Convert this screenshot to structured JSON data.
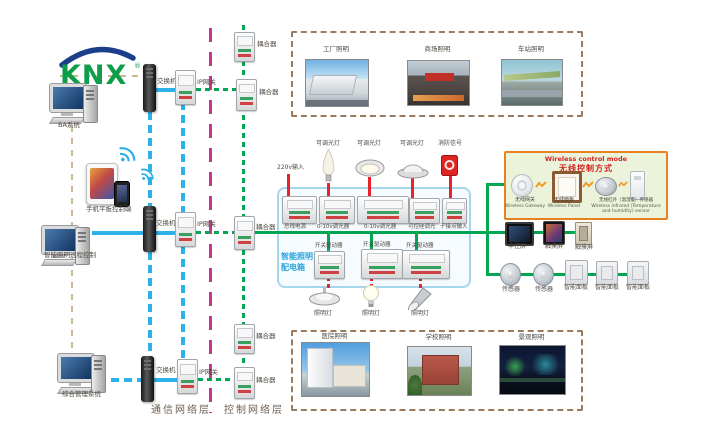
{
  "logo": {
    "brand": "KNX",
    "registered": "®"
  },
  "left_column": {
    "ba_system": "BA系统",
    "mobile_control": "手机平板控制端",
    "remote_control": "智能照明远程控制",
    "management_system": "综合管理系统"
  },
  "network": {
    "switch_top": "交换机",
    "gateway_top": "IP网关",
    "switch_mid": "交换机",
    "gateway_mid": "IP网关",
    "switch_bottom": "交换机",
    "gateway_bottom": "IP网关",
    "coupler_1": "耦合器",
    "coupler_2": "耦合器",
    "coupler_3": "耦合器",
    "coupler_4": "耦合器",
    "coupler_5": "耦合器"
  },
  "layers": {
    "communication": "通信网络层",
    "control": "控制网络层"
  },
  "top_photos": {
    "labels": [
      "工厂照明",
      "商场照明",
      "车站照明"
    ]
  },
  "bottom_photos": {
    "labels": [
      "医院照明",
      "学校照明",
      "景观照明"
    ]
  },
  "distribution_box": {
    "title_line1": "智能照明",
    "title_line2": "配电箱",
    "power_input": "220v输入",
    "top_devices": [
      "总线电源",
      "0-10v调光器",
      "0-10v调光器",
      "可控硅调光",
      "干接点输入"
    ],
    "top_loads": [
      "可调光灯",
      "可调光灯",
      "可调光灯",
      "消防信号"
    ],
    "bottom_devices": [
      "开关驱动器",
      "开关驱动器",
      "开关驱动器"
    ],
    "bottom_loads": [
      "照明灯",
      "照明灯",
      "照明灯"
    ]
  },
  "wireless_box": {
    "title_en": "Wireless control mode",
    "title_cn": "无线控制方式",
    "items": [
      {
        "cn": "无线网关",
        "en": "Wireless Gateway"
      },
      {
        "cn": "无线面板",
        "en": "Wireless Panel"
      },
      {
        "cn": "无线红外（温湿度）传感器",
        "en": "Wireless infrared (Temperature and humidity) sensor"
      }
    ]
  },
  "right_devices": {
    "screens": [
      "中控屏",
      "触摸屏",
      "触摸屏"
    ],
    "sensors": [
      "传感器",
      "传感器"
    ],
    "panels": [
      "智能面板",
      "智能面板",
      "智能面板"
    ]
  },
  "colors": {
    "communication_line": "#2bb2e8",
    "control_line": "#00a651",
    "load_line": "#e8242a",
    "layer_divider": "#c9338f",
    "left_link_line": "#c9b98f",
    "distribution_box_border": "#a5d6ec",
    "wireless_box_border": "#e8821e",
    "wireless_box_bg": "#ebf3da",
    "photo_frame_dash": "#9a7b5f",
    "logo_green": "#0e9e49",
    "logo_blue": "#1b3f8a"
  }
}
